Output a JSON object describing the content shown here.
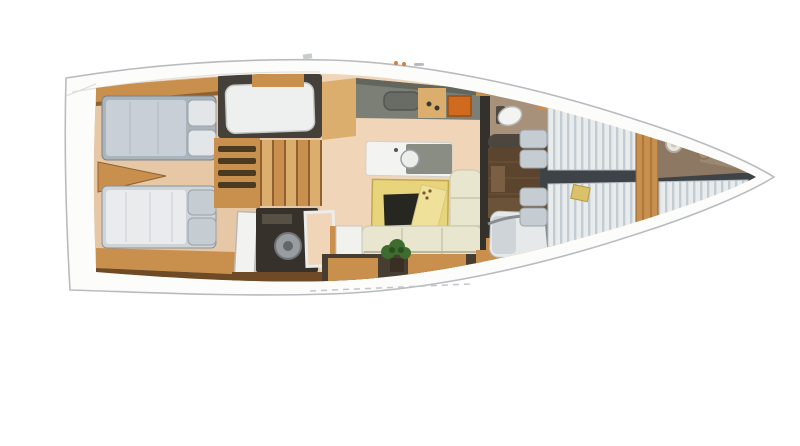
{
  "palette": {
    "background": "#ffffff",
    "hull": "#fcfcfb",
    "hull_outline": "#b8bcbf",
    "floor": "#e6c8a6",
    "floor_salon": "#f0d5b8",
    "wood": "#c98f4d",
    "wood_light": "#dcae6e",
    "wood_dark": "#8f6130",
    "wood_deep": "#6e4b26",
    "sole": "#5c452e",
    "bulkhead": "#45413a",
    "wall": "#34312c",
    "counter": "#7c7f75",
    "counter_dark": "#63665d",
    "mattress_blue": "#aab4bd",
    "duvet_blue": "#c8cfd6",
    "mattress_white": "#e9eced",
    "mattress_stripe": "#c3ccd3",
    "pillow": "#e3e6e8",
    "pillow_gray": "#c6cdd2",
    "cream": "#e9e6d0",
    "cream_shade": "#c9c6ab",
    "table": "#e8d47b",
    "notepad": "#efe19a",
    "hatch": "#262721",
    "stove": "#d06a1e",
    "plant": "#3e6b2e",
    "plant_dark": "#2c4d1f",
    "fixture": "#f3f4f2",
    "appliance": "#979da0",
    "taupe": "#8d7963",
    "taupe_light": "#a8917a",
    "centerline": "#3e4347"
  },
  "areas": {
    "aft-cabin-port": "double berth with gray-blue mattress and two pillows (stern, top)",
    "aft-cabin-starboard": "double berth with white mattress and two pillows (stern, bottom)",
    "single-berth-mid": "white single berth in dark-walled compartment",
    "companionway-stairs": "wooden steps amidships",
    "drawer-unit": "wooden drawers beside stairs",
    "utility-compartment": "dark locker with round appliance drum",
    "galley": "gray counter with sink, wood insert and orange stove along top of salon",
    "island-sink": "white island counter with round sink",
    "salon-table": "yellow table with dark hatch and sketched notepad",
    "settee": "cream L-shaped sofa",
    "houseplant": "green plant at salon aft cabinets",
    "mid-head": "toilet compartment with white bowl",
    "mid-berth": "single berth with rolled cushion and chrome rail",
    "forward-berth-port": "slatted white berth with pillows (top)",
    "forward-berth-starboard": "slatted white berth with pillows (bottom)",
    "forepeak": "tapering bow compartment with round sink and hatch"
  }
}
